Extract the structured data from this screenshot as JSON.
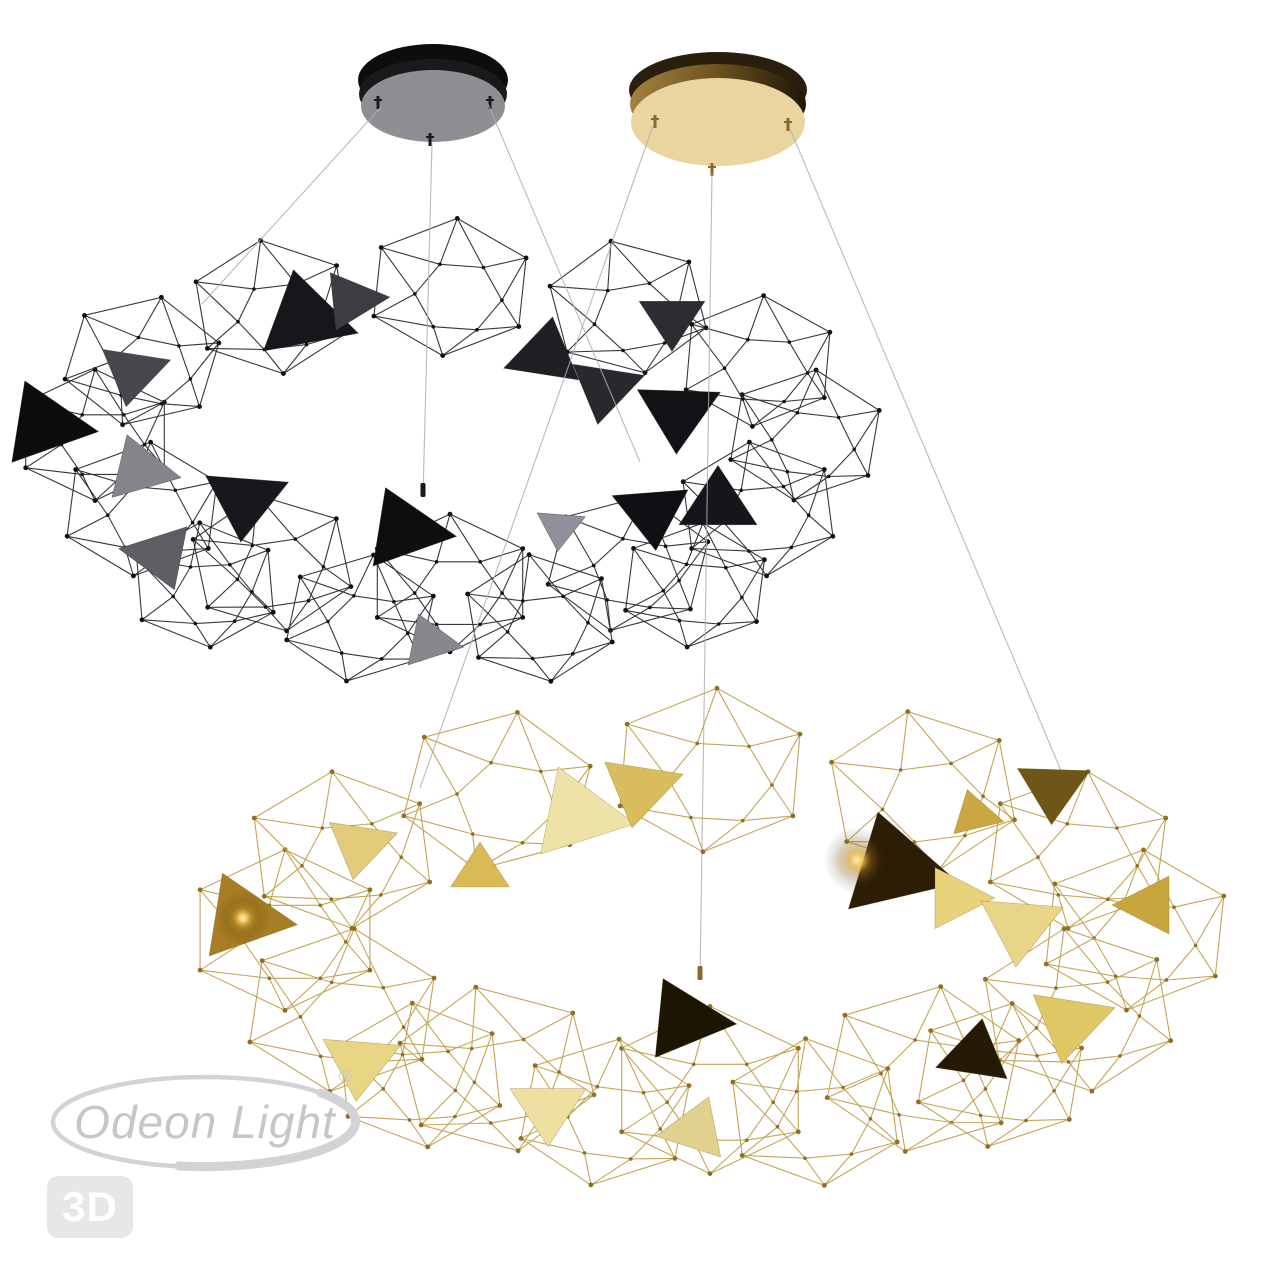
{
  "watermark": {
    "logo_text": "Odeon Light",
    "registered_symbol": "®",
    "badge_text": "3D",
    "logo_color": "#c6c6c8",
    "swoosh_color": "#d3d3d5",
    "badge_bg": "#e7e7e8",
    "badge_text_color": "#ffffff"
  },
  "scene": {
    "background": "#ffffff",
    "suspension_wire_color": "#aeaeb2",
    "canopies": [
      {
        "name": "ceiling-canopy-black",
        "cx": 433,
        "rim": {
          "cy": 80,
          "rx": 75,
          "ry": 36,
          "fill": "#0d0d0e"
        },
        "side": {
          "cy": 94,
          "rx": 74,
          "ry": 35,
          "fill": "#1a1a1c"
        },
        "base": {
          "cy": 106,
          "rx": 72,
          "ry": 36,
          "fill": "#8f8f93"
        },
        "pin_color": "#1b1b1d",
        "pins": [
          [
            378,
            103
          ],
          [
            490,
            103
          ],
          [
            430,
            140
          ]
        ]
      },
      {
        "name": "ceiling-canopy-gold",
        "cx": 718,
        "rim": {
          "cy": 90,
          "rx": 89,
          "ry": 38,
          "fill": "#2a1f0e"
        },
        "side": {
          "cy": 104,
          "rx": 88,
          "ry": 40,
          "fill": "url(#gold-side)"
        },
        "base": {
          "cy": 122,
          "rx": 87,
          "ry": 44,
          "fill": "#ead5a0"
        },
        "pin_color": "#8a6a28",
        "pins": [
          [
            655,
            122
          ],
          [
            788,
            125
          ],
          [
            712,
            170
          ]
        ]
      }
    ],
    "wires": [
      {
        "x1": 381,
        "y1": 107,
        "x2": 202,
        "y2": 304
      },
      {
        "x1": 432,
        "y1": 143,
        "x2": 423,
        "y2": 497,
        "cap": "#1a1a1c"
      },
      {
        "x1": 488,
        "y1": 104,
        "x2": 640,
        "y2": 462
      },
      {
        "x1": 653,
        "y1": 126,
        "x2": 420,
        "y2": 788
      },
      {
        "x1": 712,
        "y1": 174,
        "x2": 700,
        "y2": 980,
        "cap": "#8a6a28"
      },
      {
        "x1": 790,
        "y1": 129,
        "x2": 1062,
        "y2": 773
      }
    ],
    "chandeliers": [
      {
        "name": "black-chandelier",
        "edge_color": "#2c2c31",
        "node_color": "#111114",
        "panel_stroke": "rgba(40,40,45,0.5)",
        "cells": [
          [
            805,
            435,
            80,
            8
          ],
          [
            758,
            509,
            82,
            -6
          ],
          [
            628,
            563,
            84,
            12
          ],
          [
            450,
            583,
            84,
            0
          ],
          [
            272,
            563,
            84,
            -10
          ],
          [
            142,
            509,
            82,
            6
          ],
          [
            95,
            435,
            80,
            0
          ],
          [
            142,
            361,
            80,
            14
          ],
          [
            272,
            307,
            82,
            -8
          ],
          [
            450,
            287,
            84,
            5
          ],
          [
            628,
            307,
            82,
            -12
          ],
          [
            758,
            361,
            80,
            4
          ],
          [
            695,
            585,
            76,
            6
          ],
          [
            540,
            618,
            78,
            -8
          ],
          [
            360,
            618,
            78,
            10
          ],
          [
            205,
            585,
            76,
            -4
          ]
        ],
        "panels": [
          [
            305,
            318,
            56,
            18,
            "#17171b"
          ],
          [
            352,
            300,
            38,
            115,
            "#3c3c42"
          ],
          [
            45,
            425,
            54,
            8,
            "#0c0c0f"
          ],
          [
            133,
            372,
            40,
            100,
            "#47474d"
          ],
          [
            140,
            470,
            42,
            12,
            "#84848a"
          ],
          [
            160,
            555,
            42,
            70,
            "#5e5e64"
          ],
          [
            245,
            500,
            48,
            95,
            "#18181c"
          ],
          [
            405,
            530,
            52,
            8,
            "#0e0e11"
          ],
          [
            545,
            355,
            44,
            40,
            "#1f1f24"
          ],
          [
            605,
            388,
            42,
            100,
            "#28282d"
          ],
          [
            672,
            318,
            38,
            90,
            "#2c2c31"
          ],
          [
            678,
            412,
            48,
            92,
            "#121216"
          ],
          [
            652,
            512,
            44,
            85,
            "#101014"
          ],
          [
            718,
            505,
            45,
            30,
            "#16161a"
          ],
          [
            560,
            527,
            28,
            95,
            "#90909a"
          ],
          [
            430,
            642,
            34,
            10,
            "#87878d"
          ]
        ]
      },
      {
        "name": "gold-chandelier",
        "edge_color": "#c2a04e",
        "node_color": "#8f6f26",
        "panel_stroke": "rgba(130,100,30,0.45)",
        "cells": [
          [
            1135,
            930,
            98,
            5
          ],
          [
            1078,
            1010,
            100,
            -8
          ],
          [
            923,
            1069,
            102,
            10
          ],
          [
            710,
            1090,
            102,
            0
          ],
          [
            497,
            1069,
            102,
            -12
          ],
          [
            342,
            1010,
            100,
            7
          ],
          [
            285,
            930,
            98,
            0
          ],
          [
            342,
            850,
            96,
            -6
          ],
          [
            497,
            791,
            98,
            12
          ],
          [
            710,
            770,
            100,
            4
          ],
          [
            923,
            791,
            98,
            -9
          ],
          [
            1078,
            850,
            96,
            6
          ],
          [
            1000,
            1075,
            88,
            8
          ],
          [
            815,
            1112,
            90,
            -6
          ],
          [
            605,
            1112,
            90,
            9
          ],
          [
            420,
            1075,
            88,
            -5
          ]
        ],
        "panels": [
          [
            578,
            815,
            58,
            10,
            "#efe2a6"
          ],
          [
            640,
            788,
            46,
            100,
            "#d9bc5c"
          ],
          [
            895,
            868,
            66,
            15,
            "#2b1d06",
            [
              -38,
              -8
            ]
          ],
          [
            1053,
            788,
            42,
            92,
            "#6e5518"
          ],
          [
            975,
            815,
            30,
            15,
            "#caa743"
          ],
          [
            243,
            918,
            55,
            8,
            "#a87e24",
            [
              0,
              0
            ]
          ],
          [
            360,
            845,
            40,
            100,
            "#e2cb7a"
          ],
          [
            360,
            1062,
            45,
            95,
            "#e9d685"
          ],
          [
            548,
            1108,
            44,
            90,
            "#eee0a0"
          ],
          [
            685,
            1020,
            52,
            5,
            "#1d1504"
          ],
          [
            955,
            898,
            40,
            120,
            "#e8d27a"
          ],
          [
            1020,
            925,
            48,
            95,
            "#e9d587"
          ],
          [
            695,
            1130,
            40,
            170,
            "#e0d18e"
          ],
          [
            1070,
            1022,
            48,
            100,
            "#dfc766"
          ],
          [
            975,
            1055,
            42,
            160,
            "#241a06"
          ],
          [
            1150,
            905,
            38,
            60,
            "#c9a53e"
          ],
          [
            480,
            872,
            34,
            150,
            "#d9ba55"
          ]
        ]
      }
    ]
  }
}
